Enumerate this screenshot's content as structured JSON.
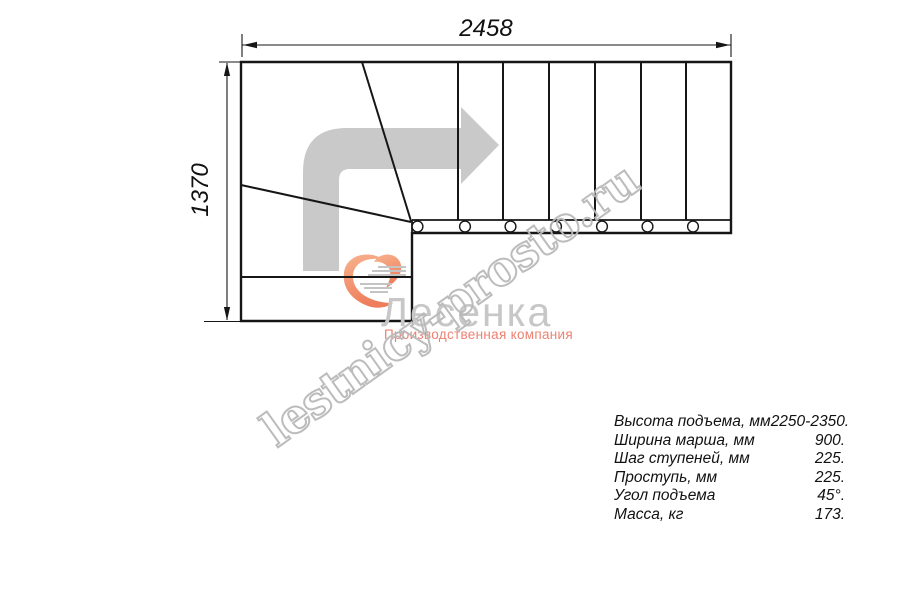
{
  "drawing": {
    "type": "stair-plan-top-view",
    "description": "L-shaped (90-degree turn) staircase plan with winder steps, direction arrow pointing up then right",
    "straight_treads": 7,
    "winder_divider_lines": 2,
    "baluster_circles": 7,
    "line_color": "#161616",
    "direction_arrow_color": "#c9c9c9"
  },
  "dims": {
    "width_label": "2458",
    "height_label": "1370"
  },
  "watermark": {
    "text": "lestnicy-prosto.ru",
    "outline_color": "#b9b9b9"
  },
  "logo": {
    "name": "Лесенка",
    "tagline": "Производственная компания",
    "name_color": "#c7c7c7",
    "tagline_color": "#ed8172",
    "heart_color_top": "#f8b28e",
    "heart_color_bottom": "#ee7d5b",
    "speedline_color": "#c4c4c4"
  },
  "specs": {
    "rows": [
      {
        "label": "Высота подъема, мм",
        "value": "2250-2350."
      },
      {
        "label": "Ширина марша, мм",
        "value": "900."
      },
      {
        "label": "Шаг ступеней, мм",
        "value": "225."
      },
      {
        "label": "Проступь, мм",
        "value": "225."
      },
      {
        "label": "Угол подъема",
        "value": "45°."
      },
      {
        "label": "Масса, кг",
        "value": "173."
      }
    ]
  }
}
